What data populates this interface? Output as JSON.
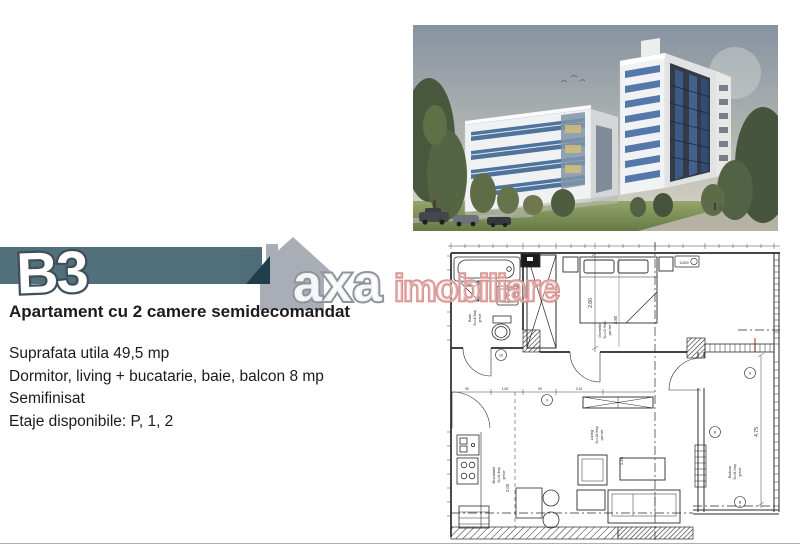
{
  "banner": {
    "label": "B3",
    "bar_color": "#52707b",
    "fold_color": "#1f3e4a",
    "outline_color": "#3e4f59"
  },
  "logo": {
    "axa": "axa",
    "imobiliare": "imobiliare",
    "axa_color": "#8f939d",
    "imobiliare_color": "#d9928f",
    "house_color": "#a9adb6"
  },
  "listing": {
    "title": "Apartament cu 2 camere semidecomandat",
    "details": [
      "Suprafata utila 49,5 mp",
      "Dormitor, living + bucatarie, baie, balcon 8 mp",
      "Semifinisat",
      "Etaje disponibile: P, 1, 2"
    ]
  },
  "floorplan": {
    "rooms": [
      {
        "name": "Baie",
        "area": "Su=4.3mp",
        "finish": "gresie"
      },
      {
        "name": "Dormitor",
        "area": "Su=12.9mp",
        "finish": "parchet"
      },
      {
        "name": "Living",
        "area": "Su=18.9mp",
        "finish": "parchet"
      },
      {
        "name": "Bucatarie",
        "area": "Su=6.4mp",
        "finish": "gresie"
      },
      {
        "name": "Balcon",
        "area": "Su=8.0mp",
        "finish": "gresie"
      }
    ],
    "dims": {
      "bedroom_w": "2.80",
      "bedroom_l": "3.80",
      "living": "1.45",
      "kitchen": "2.00",
      "balcony": "4.75"
    },
    "hall_dims": [
      "90",
      "1.00",
      "90",
      "2.10"
    ],
    "radiator_code": "11600",
    "markers": [
      "10",
      "9",
      "8",
      "B",
      "B"
    ]
  },
  "photo_colors": {
    "sky_top": "#8793a1",
    "glass_blue": "#3f68a0",
    "facade": "#f0f2f3"
  }
}
